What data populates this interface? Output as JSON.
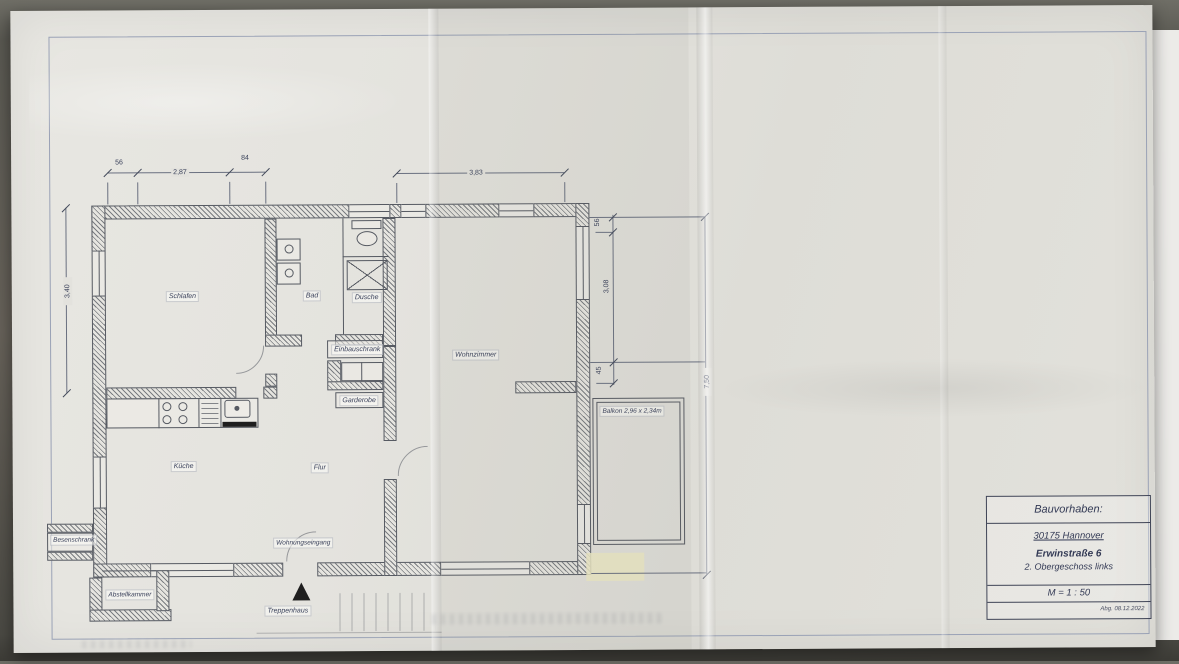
{
  "title_block": {
    "header": "Bauvorhaben:",
    "line1": "30175 Hannover",
    "line2": "Erwinstraße 6",
    "line3": "2. Obergeschoss links",
    "scale": "M = 1 : 50",
    "note": "Abg. 08.12.2022"
  },
  "rooms": {
    "schlafen": "Schlafen",
    "bad": "Bad",
    "dusche": "Dusche",
    "einbauschrank": "Einbauschrank",
    "garderobe": "Garderobe",
    "wohnzimmer": "Wohnzimmer",
    "kueche": "Küche",
    "flur": "Flur",
    "wohnungseingang": "Wohnungseingang",
    "treppenhaus": "Treppenhaus",
    "abstellkammer": "Abstellkammer",
    "besenschrank": "Besenschrank",
    "balkon": "Balkon 2,96 x 2,34m"
  },
  "dimensions": {
    "top_a": "56",
    "top_b": "2,87",
    "top_c": "84",
    "top_wide": "3,83",
    "left_v": "3,40",
    "right_a": "56",
    "right_b": "3,08",
    "right_c": "45",
    "right_total": "7,50"
  },
  "colors": {
    "paper": "#e3e2dd",
    "ink": "#39405a",
    "wall_line": "#565a62",
    "highlight": "#ece9c4"
  }
}
